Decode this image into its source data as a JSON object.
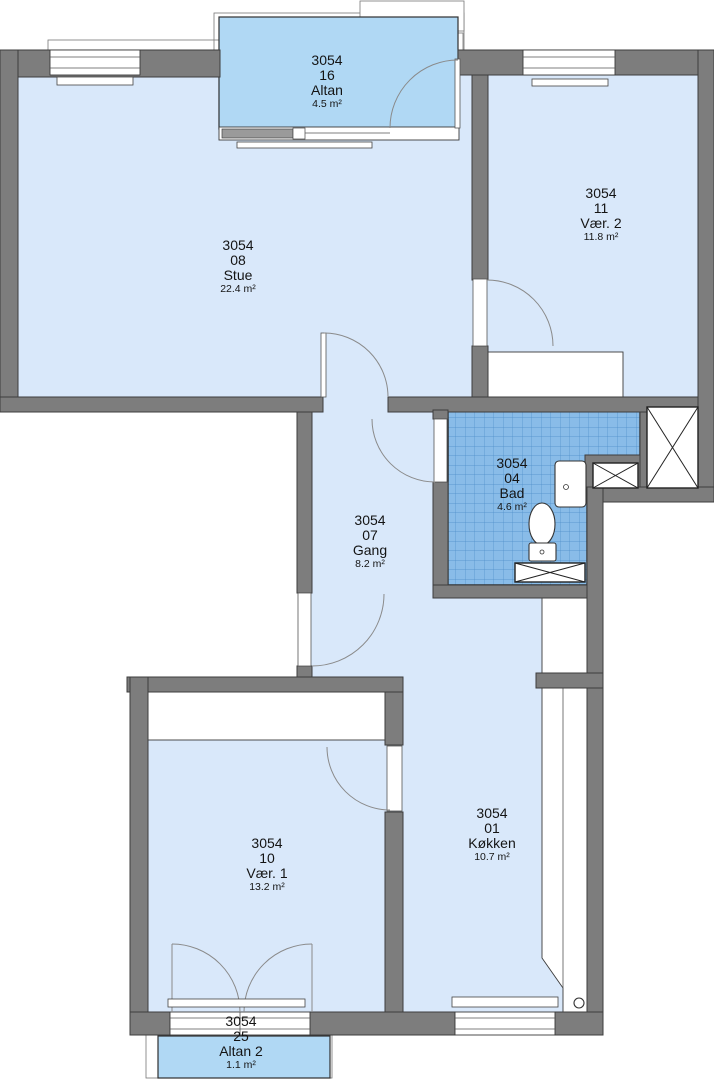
{
  "rooms": [
    {
      "id": "3054",
      "no": "16",
      "name": "Altan",
      "area": "4.5 m²"
    },
    {
      "id": "3054",
      "no": "08",
      "name": "Stue",
      "area": "22.4 m²"
    },
    {
      "id": "3054",
      "no": "11",
      "name": "Vær. 2",
      "area": "11.8 m²"
    },
    {
      "id": "3054",
      "no": "07",
      "name": "Gang",
      "area": "8.2 m²"
    },
    {
      "id": "3054",
      "no": "04",
      "name": "Bad",
      "area": "4.6 m²"
    },
    {
      "id": "3054",
      "no": "10",
      "name": "Vær. 1",
      "area": "13.2 m²"
    },
    {
      "id": "3054",
      "no": "01",
      "name": "Køkken",
      "area": "10.7 m²"
    },
    {
      "id": "3054",
      "no": "25",
      "name": "Altan 2",
      "area": "1.1 m²"
    }
  ],
  "colors": {
    "wall": "#7d7d7d",
    "wall_line": "#3d3d3d",
    "room_fill": "#d9e8fa",
    "balcony_fill": "#b0d8f4",
    "bath_tile": "#89bce8",
    "tile_grid": "#4d8dc9",
    "door_arc": "#8a8a8a"
  }
}
